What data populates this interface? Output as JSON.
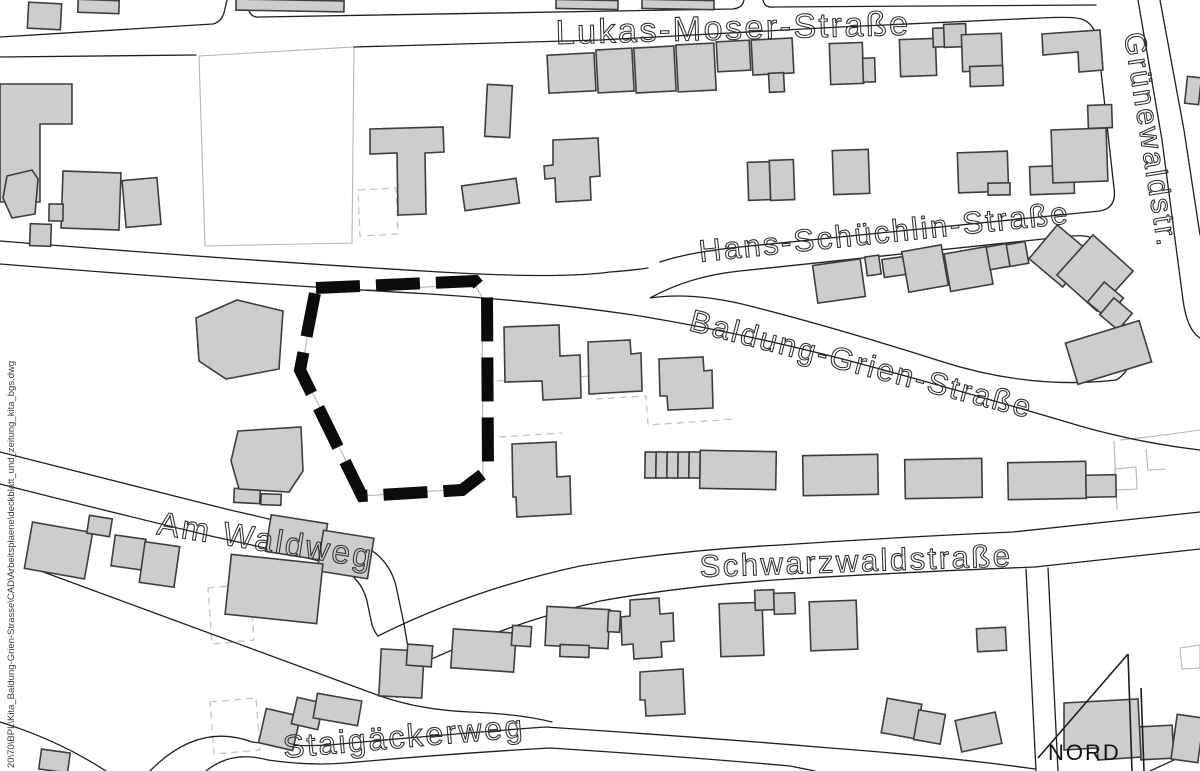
{
  "map": {
    "background": "#ffffff",
    "colors": {
      "road": "#1f1f1f",
      "light_parcel": "#b5b5b5",
      "dashed_planned": "#c4c4c4",
      "building_fill": "#cdcdcd",
      "building_stroke": "#3d3d3d",
      "site_boundary": "#0b0b0b",
      "street_label": "#2e2e2e"
    },
    "street_labels": [
      {
        "name": "lukas-moser-strasse",
        "text": "Lukas-Moser-Straße",
        "x": 556,
        "y": 44,
        "rotate": -1.5,
        "size": 34
      },
      {
        "name": "gruenewaldstr",
        "text": "Grünewaldstr.",
        "x": 1124,
        "y": 34,
        "rotate": 81,
        "size": 30
      },
      {
        "name": "hans-schuechlin-strasse",
        "text": "Hans-Schüchlin-Straße",
        "x": 700,
        "y": 262,
        "rotate": -6,
        "size": 31
      },
      {
        "name": "baldung-grien-strasse",
        "text": "Baldung-Grien-Straße",
        "x": 688,
        "y": 330,
        "rotate": 14.5,
        "size": 31
      },
      {
        "name": "am-waldweg",
        "text": "Am Waldweg",
        "x": 156,
        "y": 534,
        "rotate": 9,
        "size": 33
      },
      {
        "name": "schwarzwaldstrasse",
        "text": "Schwarzwaldstraße",
        "x": 700,
        "y": 577,
        "rotate": -2,
        "size": 31
      },
      {
        "name": "staigaeckerweg",
        "text": "Staigäckerweg",
        "x": 284,
        "y": 758,
        "rotate": -5,
        "size": 32
      }
    ],
    "north_arrow": {
      "label": "NORD",
      "label_x": 1048,
      "label_y": 760,
      "label_size": 22,
      "lines": [
        "M 1128,654 L 1038,758",
        "M 1128,654 L 1132,771",
        "M 1141,688 L 1144,771"
      ]
    },
    "file_path_note": {
      "text": "20\\70\\BPL\\Kita_Baldung-Grien-Strasse\\CAD\\Arbeitsplaene\\deckblatt_und_zeitung_kita_bgs.dwg",
      "x": 14,
      "y": 768,
      "rotate": -90,
      "size": 9.5
    },
    "roads": [
      "M 0,37 L 213,24 Q 221,22 224,13 L 227,0",
      "M 246,0 L 249,11 Q 252,18 260,17 L 733,9 Q 741,8 743,3 L 744,0",
      "M 763,0 L 764,3 Q 766,8 774,7 L 1096,5",
      "M 0,57 L 196,55",
      "M 354,47 L 600,40 Q 720,33 840,27 L 1040,18 Q 1078,16 1084,20 Q 1096,26 1098,44 L 1114,188 Q 1117,208 1100,211 L 740,247 Q 690,252 660,262",
      "M 0,241 Q 250,261 440,272 Q 560,279 610,272 Q 635,270 648,268",
      "M 0,264 Q 250,284 430,294 Q 540,301 640,316 Q 760,336 880,369 Q 1000,402 1080,426 Q 1140,443 1200,450",
      "M 650,298 Q 690,276 740,271 L 1072,236 Q 1096,234 1102,246 L 1128,338 Q 1136,369 1116,380 Q 1030,390 940,361 Q 830,326 742,304 Q 690,292 650,298 Z",
      "M 1138,0 L 1162,140 L 1183,300 Q 1187,330 1200,338",
      "M 1160,0 L 1184,130 L 1200,235",
      "M 378,636 Q 470,590 580,566 Q 680,550 780,545 Q 900,537 1013,532 L 1200,512",
      "M 412,668 Q 500,626 600,601 Q 690,585 790,579 Q 930,571 1035,567 L 1200,549",
      "M 0,452 Q 120,482 230,510 Q 310,528 352,541 Q 388,553 396,586 L 404,624 Q 409,654 412,668",
      "M 0,484 Q 110,512 215,537 Q 290,553 330,564 Q 360,573 367,601 L 372,625 Q 375,633 378,636",
      "M 27,566 L 380,696 Q 420,710 470,712 Q 520,714 552,722",
      "M 150,771 Q 198,722 252,742 Q 300,748 340,744 Q 450,734 545,727 Q 700,737 830,748 Q 950,757 1035,769",
      "M 206,771 Q 232,750 268,760 Q 310,766 345,763 Q 460,753 550,748 Q 690,757 790,766 L 815,771",
      "M 0,722 Q 58,740 106,771",
      "M 1026,569 L 1036,771",
      "M 1048,568 L 1058,771",
      "M 1150,771 L 1200,748"
    ],
    "light_lines": [
      "M 199,56 L 354,47 L 352,243 L 205,246 Z",
      "M 314,292 L 475,285 L 482,297 L 483,476 L 462,489 L 363,496 L 302,371 Z",
      "M 1114,441 L 1117,509",
      "M 1115,469 L 1136,467 L 1137,489 L 1116,490 Z",
      "M 1146,449 L 1148,470 L 1166,469",
      "M 1180,648 L 1200,645 L 1200,668 L 1182,669 Z",
      "M 1120,440 Q 1160,436 1200,430"
    ],
    "dashed_lines": [
      "M 358,190 L 396,188 L 398,234 L 360,236 Z",
      "M 497,381 L 592,376 L 594,399 L 646,396 L 648,425 L 736,419",
      "M 499,437 L 562,433",
      "M 208,588 L 250,584 L 254,640 L 212,644 Z",
      "M 210,702 L 256,698 L 260,750 L 214,754 Z"
    ],
    "site_boundary": {
      "points": "316,288 475,281 487,295 488,470 462,490 362,496 300,370"
    },
    "buildings": {
      "rects": [
        [
          28,
          3,
          33,
          26,
          3
        ],
        [
          78,
          0,
          41,
          13,
          2
        ],
        [
          236,
          0,
          108,
          11,
          1
        ],
        [
          556,
          0,
          62,
          9,
          1
        ],
        [
          642,
          0,
          72,
          9,
          1
        ],
        [
          1186,
          77,
          14,
          27,
          6
        ],
        [
          62,
          172,
          58,
          57,
          2
        ],
        [
          30,
          224,
          21,
          22,
          2
        ],
        [
          49,
          204,
          14,
          17,
          1
        ],
        [
          124,
          179,
          35,
          47,
          -5
        ],
        [
          548,
          54,
          47,
          38,
          -3
        ],
        [
          597,
          49,
          36,
          43,
          -3
        ],
        [
          635,
          47,
          40,
          45,
          -3
        ],
        [
          677,
          44,
          38,
          47,
          -3
        ],
        [
          717,
          41,
          33,
          30,
          -3
        ],
        [
          752,
          39,
          41,
          35,
          -3
        ],
        [
          769,
          73,
          15,
          19,
          -3
        ],
        [
          830,
          43,
          33,
          41,
          -2
        ],
        [
          863,
          58,
          12,
          24,
          -2
        ],
        [
          900,
          39,
          36,
          37,
          -2
        ],
        [
          933,
          28,
          12,
          19,
          -2
        ],
        [
          944,
          24,
          22,
          23,
          -2
        ],
        [
          962,
          34,
          40,
          37,
          -2
        ],
        [
          970,
          66,
          33,
          20,
          -2
        ],
        [
          748,
          162,
          22,
          38,
          -2
        ],
        [
          770,
          160,
          24,
          40,
          -2
        ],
        [
          833,
          150,
          36,
          44,
          -2
        ],
        [
          958,
          152,
          50,
          40,
          -2
        ],
        [
          988,
          183,
          22,
          12,
          -1
        ],
        [
          1030,
          166,
          44,
          28,
          -2
        ],
        [
          1052,
          129,
          55,
          53,
          -2
        ],
        [
          1088,
          105,
          24,
          23,
          -2
        ],
        [
          486,
          85,
          25,
          52,
          3
        ],
        [
          463,
          182,
          55,
          25,
          -8
        ],
        [
          815,
          262,
          48,
          38,
          -8
        ],
        [
          866,
          256,
          14,
          19,
          -8
        ],
        [
          883,
          258,
          22,
          18,
          -8
        ],
        [
          905,
          248,
          40,
          41,
          -10
        ],
        [
          947,
          250,
          43,
          38,
          -10
        ],
        [
          988,
          245,
          22,
          23,
          -10
        ],
        [
          1008,
          243,
          19,
          22,
          -10
        ],
        [
          1038,
          234,
          44,
          44,
          40
        ],
        [
          1068,
          246,
          54,
          54,
          42
        ],
        [
          1093,
          287,
          25,
          26,
          40
        ],
        [
          1104,
          303,
          24,
          22,
          40
        ],
        [
          1070,
          331,
          77,
          43,
          -17
        ],
        [
          645,
          452,
          11,
          26,
          1
        ],
        [
          656,
          452,
          11,
          26,
          1
        ],
        [
          667,
          452,
          11,
          26,
          1
        ],
        [
          678,
          452,
          11,
          26,
          1
        ],
        [
          689,
          452,
          11,
          26,
          1
        ],
        [
          700,
          451,
          76,
          38,
          1
        ],
        [
          803,
          455,
          75,
          40,
          -1
        ],
        [
          905,
          459,
          77,
          39,
          -1
        ],
        [
          1008,
          462,
          78,
          37,
          -1
        ],
        [
          1086,
          475,
          30,
          22,
          -1
        ],
        [
          234,
          489,
          26,
          14,
          3
        ],
        [
          261,
          494,
          20,
          11,
          2
        ],
        [
          380,
          650,
          43,
          47,
          3
        ],
        [
          407,
          645,
          25,
          21,
          4
        ],
        [
          452,
          631,
          63,
          39,
          4
        ],
        [
          512,
          626,
          19,
          20,
          4
        ],
        [
          546,
          608,
          63,
          39,
          3
        ],
        [
          608,
          611,
          12,
          21,
          3
        ],
        [
          560,
          645,
          29,
          12,
          2
        ],
        [
          720,
          603,
          43,
          53,
          -2
        ],
        [
          755,
          590,
          19,
          20,
          -2
        ],
        [
          774,
          593,
          21,
          21,
          -2
        ],
        [
          810,
          601,
          47,
          49,
          -2
        ],
        [
          977,
          628,
          29,
          23,
          -3
        ],
        [
          262,
          712,
          35,
          35,
          13
        ],
        [
          294,
          700,
          27,
          27,
          13
        ],
        [
          315,
          697,
          45,
          25,
          10
        ],
        [
          40,
          751,
          29,
          20,
          8
        ],
        [
          884,
          701,
          35,
          35,
          10
        ],
        [
          916,
          712,
          27,
          30,
          10
        ],
        [
          958,
          716,
          41,
          32,
          -12
        ],
        [
          28,
          527,
          61,
          47,
          10
        ],
        [
          88,
          517,
          23,
          18,
          9
        ],
        [
          113,
          537,
          31,
          31,
          8
        ],
        [
          142,
          544,
          35,
          41,
          8
        ],
        [
          268,
          519,
          57,
          37,
          9
        ],
        [
          320,
          534,
          51,
          41,
          9
        ],
        [
          228,
          559,
          92,
          60,
          6
        ],
        [
          1140,
          726,
          33,
          33,
          -3
        ],
        [
          1174,
          716,
          27,
          45,
          8
        ]
      ],
      "polys": [
        "0,84 72,84 72,124 40,124 40,202 0,202",
        "7,176 32,170 38,179 35,214 12,218 3,198",
        "370,129 443,127 444,152 425,153 426,214 398,215 397,153 370,154",
        "1042,34 1100,30 1103,70 1079,72 1078,52 1043,55",
        "553,140 598,138 600,176 590,177 591,200 556,202 555,178 545,179 544,166 553,165",
        "504,327 559,325 560,356 580,355 581,398 543,400 542,381 505,382",
        "588,342 630,340 631,354 641,353 642,391 589,394",
        "659,359 703,357 704,371 712,370 713,408 668,410 667,396 660,396",
        "512,444 556,442 557,477 570,476 571,514 517,517 516,497 513,497",
        "196,318 237,300 283,311 279,369 226,379 199,361",
        "238,431 301,427 303,471 289,492 239,489 231,461",
        "630,600 659,598 660,614 673,613 674,641 661,642 662,657 634,659 633,644 622,645 621,617 630,616",
        "640,672 683,669 685,714 646,716 645,700 640,700",
        "1064,703 1138,699 1141,757 1098,760 1097,748 1064,750"
      ]
    }
  }
}
